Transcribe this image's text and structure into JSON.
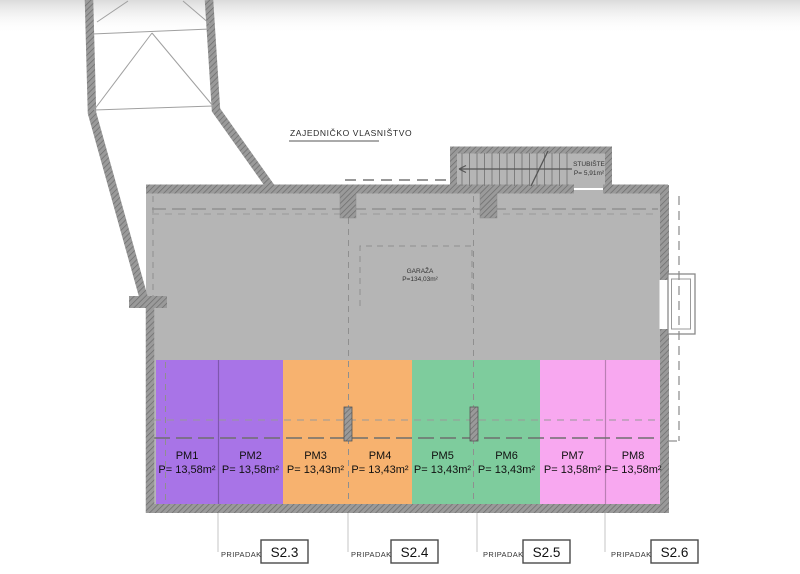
{
  "plan": {
    "common_area_label": "ZAJEDNIČKO VLASNIŠTVO",
    "staircase": {
      "name": "STUBIŠTE",
      "area": "P= 5,91m²"
    },
    "garage": {
      "name": "GARAŽA",
      "area": "P=134,03m²"
    },
    "parking_spaces": [
      {
        "id": "PM1",
        "area": "P= 13,58m²"
      },
      {
        "id": "PM2",
        "area": "P= 13,58m²"
      },
      {
        "id": "PM3",
        "area": "P= 13,43m²"
      },
      {
        "id": "PM4",
        "area": "P= 13,43m²"
      },
      {
        "id": "PM5",
        "area": "P= 13,43m²"
      },
      {
        "id": "PM6",
        "area": "P= 13,43m²"
      },
      {
        "id": "PM7",
        "area": "P= 13,58m²"
      },
      {
        "id": "PM8",
        "area": "P= 13,58m²"
      }
    ],
    "ownership_tags": [
      {
        "label": "PRIPADAK",
        "unit": "S2.3"
      },
      {
        "label": "PRIPADAK",
        "unit": "S2.4"
      },
      {
        "label": "PRIPADAK",
        "unit": "S2.5"
      },
      {
        "label": "PRIPADAK",
        "unit": "S2.6"
      }
    ],
    "colors": {
      "purple": "#a874e7",
      "orange": "#f7b26f",
      "green": "#7ecc9d",
      "pink": "#f8a8f0",
      "floor": "#b5b5b5"
    }
  }
}
